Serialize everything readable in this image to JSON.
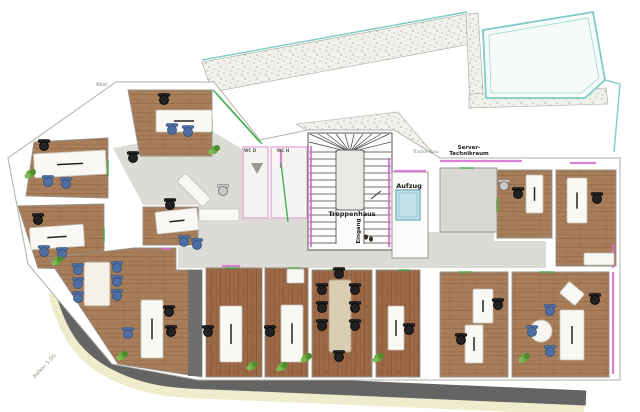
{
  "labels": {
    "treppenhaus": {
      "text": "Treppenhaus"
    },
    "eingang": {
      "text": "Eingang"
    },
    "aufzug": {
      "text": "Aufzug"
    },
    "server_line1": {
      "text": "Server-"
    },
    "server_line2": {
      "text": "Technikraum"
    },
    "trockenbau": {
      "text": "Trockenbau"
    },
    "wc_d": {
      "text": "WC D"
    },
    "wc_h": {
      "text": "WC H"
    },
    "abst": {
      "text": "Abst."
    },
    "balkon": {
      "text": "Balkon 5.OG"
    }
  },
  "colors": {
    "wood": "#a87e5a",
    "wood_red": "#9c6947",
    "corridor": "#dcdbd6",
    "road": "#646464",
    "road_edge": "#efeccd",
    "terrace_teal": "#7fccc4",
    "wall_accent": "#d66fd0",
    "glass_green": "#3fae4a",
    "elevator_blue": "#c2e2ea",
    "chair_blue": "#4e6fa4",
    "chair_black": "#222222",
    "desk_white": "#f9f8f4",
    "plant_green": "#5d9b3c",
    "wc_wall_pink": "#dfa6d6",
    "dark_strip": "#6e6e6e"
  },
  "floor_plan": {
    "base_outline": [
      [
        116,
        82
      ],
      [
        214,
        82
      ],
      [
        260,
        140
      ],
      [
        308,
        130
      ],
      [
        394,
        130
      ],
      [
        440,
        158
      ],
      [
        620,
        158
      ],
      [
        620,
        380
      ],
      [
        198,
        380
      ],
      [
        112,
        364
      ],
      [
        28,
        264
      ],
      [
        8,
        158
      ]
    ],
    "terrace": {
      "bands": [
        [
          [
            202,
            62
          ],
          [
            467,
            14
          ],
          [
            471,
            44
          ],
          [
            212,
            92
          ]
        ],
        [
          [
            466,
            14
          ],
          [
            478,
            13
          ],
          [
            484,
            106
          ],
          [
            470,
            108
          ]
        ],
        [
          [
            469,
            94
          ],
          [
            606,
            88
          ],
          [
            608,
            104
          ],
          [
            469,
            108
          ]
        ],
        [
          [
            296,
            124
          ],
          [
            398,
            112
          ],
          [
            436,
            157
          ],
          [
            392,
            131
          ],
          [
            308,
            131
          ]
        ]
      ],
      "roof_outer": [
        [
          483,
          30
        ],
        [
          593,
          12
        ],
        [
          605,
          80
        ],
        [
          585,
          98
        ],
        [
          486,
          98
        ]
      ],
      "roof_inner": [
        [
          489,
          35
        ],
        [
          588,
          18
        ],
        [
          599,
          78
        ],
        [
          581,
          93
        ],
        [
          491,
          93
        ]
      ],
      "teal_lines": [
        [
          202,
          60,
          467,
          12
        ],
        [
          605,
          80,
          620,
          84
        ],
        [
          620,
          84,
          614,
          152
        ]
      ]
    },
    "road": {
      "edge_path": "M56,292 C66,330 80,354 110,370 C140,386 168,390 212,391 L584,407",
      "main_path": "M62,288 C72,324 84,346 114,362 C142,377 168,381 212,382 L586,398"
    },
    "corridors": [
      [
        [
          113,
          148
        ],
        [
          210,
          130
        ],
        [
          244,
          150
        ],
        [
          244,
          205
        ],
        [
          143,
          205
        ]
      ],
      [
        [
          198,
          205
        ],
        [
          244,
          205
        ],
        [
          244,
          268
        ],
        [
          178,
          268
        ],
        [
          178,
          247
        ],
        [
          198,
          247
        ]
      ],
      [
        [
          244,
          218
        ],
        [
          308,
          218
        ],
        [
          308,
          268
        ],
        [
          244,
          268
        ]
      ],
      [
        [
          308,
          250
        ],
        [
          432,
          250
        ],
        [
          432,
          268
        ],
        [
          308,
          268
        ]
      ],
      [
        [
          420,
          232
        ],
        [
          494,
          232
        ],
        [
          494,
          241
        ],
        [
          546,
          241
        ],
        [
          546,
          268
        ],
        [
          420,
          268
        ]
      ]
    ],
    "rooms": [
      {
        "name": "office-a",
        "floor": "woodH",
        "points": [
          [
            34,
            142
          ],
          [
            108,
            138
          ],
          [
            108,
            198
          ],
          [
            26,
            196
          ]
        ]
      },
      {
        "name": "office-b",
        "floor": "woodH",
        "points": [
          [
            128,
            90
          ],
          [
            212,
            90
          ],
          [
            212,
            156
          ],
          [
            140,
            156
          ]
        ]
      },
      {
        "name": "office-c",
        "floor": "woodH",
        "points": [
          [
            18,
            206
          ],
          [
            104,
            204
          ],
          [
            104,
            270
          ],
          [
            38,
            268
          ]
        ]
      },
      {
        "name": "office-d",
        "floor": "woodH",
        "points": [
          [
            143,
            207
          ],
          [
            198,
            207
          ],
          [
            198,
            245
          ],
          [
            143,
            245
          ]
        ]
      },
      {
        "name": "open-office",
        "floor": "woodH",
        "points": [
          [
            48,
            258
          ],
          [
            134,
            248
          ],
          [
            176,
            248
          ],
          [
            176,
            270
          ],
          [
            202,
            270
          ],
          [
            202,
            377
          ],
          [
            118,
            364
          ]
        ]
      },
      {
        "name": "office-g",
        "floor": "woodV",
        "points": [
          [
            206,
            268
          ],
          [
            262,
            268
          ],
          [
            262,
            377
          ],
          [
            206,
            377
          ]
        ]
      },
      {
        "name": "office-h",
        "floor": "woodV",
        "points": [
          [
            265,
            268
          ],
          [
            308,
            268
          ],
          [
            308,
            377
          ],
          [
            265,
            377
          ]
        ]
      },
      {
        "name": "conference-room",
        "floor": "woodV",
        "points": [
          [
            312,
            270
          ],
          [
            372,
            270
          ],
          [
            372,
            377
          ],
          [
            312,
            377
          ]
        ]
      },
      {
        "name": "office-i",
        "floor": "woodV",
        "points": [
          [
            376,
            270
          ],
          [
            420,
            270
          ],
          [
            420,
            377
          ],
          [
            376,
            377
          ]
        ]
      },
      {
        "name": "office-j",
        "floor": "woodH",
        "points": [
          [
            440,
            272
          ],
          [
            508,
            272
          ],
          [
            508,
            377
          ],
          [
            440,
            377
          ]
        ]
      },
      {
        "name": "office-k",
        "floor": "woodH",
        "points": [
          [
            512,
            272
          ],
          [
            609,
            272
          ],
          [
            609,
            377
          ],
          [
            512,
            377
          ]
        ]
      },
      {
        "name": "office-l",
        "floor": "woodH",
        "points": [
          [
            497,
            170
          ],
          [
            552,
            170
          ],
          [
            552,
            238
          ],
          [
            497,
            238
          ]
        ]
      },
      {
        "name": "office-m",
        "floor": "woodH",
        "points": [
          [
            556,
            170
          ],
          [
            616,
            170
          ],
          [
            616,
            266
          ],
          [
            556,
            266
          ]
        ]
      },
      {
        "name": "server-room",
        "floor": "gray",
        "points": [
          [
            440,
            168
          ],
          [
            497,
            168
          ],
          [
            497,
            232
          ],
          [
            440,
            232
          ]
        ]
      },
      {
        "name": "wc-d",
        "floor": "wc",
        "points": [
          [
            243,
            147
          ],
          [
            268,
            147
          ],
          [
            268,
            218
          ],
          [
            243,
            218
          ]
        ]
      },
      {
        "name": "wc-h",
        "floor": "wc",
        "points": [
          [
            271,
            147
          ],
          [
            307,
            147
          ],
          [
            307,
            218
          ],
          [
            271,
            218
          ]
        ]
      }
    ],
    "dark_strips": [
      [
        188,
        270,
        14,
        106
      ]
    ],
    "stair": {
      "x": 308,
      "y": 133,
      "w": 84,
      "h": 117,
      "landing": [
        336,
        150,
        28,
        60
      ]
    },
    "elevator": {
      "room": [
        392,
        172,
        36,
        86
      ],
      "shaft": [
        396,
        190,
        24,
        30
      ]
    },
    "magenta_walls": [
      [
        440,
        161,
        522,
        161
      ],
      [
        570,
        163,
        596,
        163
      ],
      [
        613,
        244,
        613,
        268
      ],
      [
        613,
        272,
        613,
        374
      ],
      [
        311,
        146,
        311,
        247
      ],
      [
        389,
        158,
        389,
        247
      ],
      [
        222,
        266,
        240,
        266
      ],
      [
        162,
        249,
        170,
        249
      ],
      [
        394,
        171,
        426,
        171
      ],
      [
        281,
        150,
        281,
        168
      ]
    ],
    "green_doors": [
      [
        108,
        160,
        108,
        176
      ],
      [
        104,
        228,
        104,
        242
      ],
      [
        212,
        118,
        212,
        134
      ],
      [
        225,
        268,
        239,
        268
      ],
      [
        288,
        268,
        300,
        268
      ],
      [
        330,
        270,
        344,
        270
      ],
      [
        398,
        270,
        410,
        270
      ],
      [
        458,
        272,
        472,
        272
      ],
      [
        540,
        272,
        554,
        272
      ],
      [
        497,
        198,
        497,
        212
      ],
      [
        460,
        168,
        474,
        168
      ],
      [
        213,
        90,
        259,
        141
      ],
      [
        216,
        93,
        262,
        144
      ],
      [
        281,
        163,
        288,
        222
      ]
    ],
    "desks": [
      {
        "r": [
          34,
          152,
          72,
          24
        ],
        "rot": -3
      },
      {
        "r": [
          156,
          110,
          56,
          22
        ]
      },
      {
        "r": [
          30,
          226,
          54,
          22
        ],
        "rot": -4
      },
      {
        "r": [
          156,
          210,
          42,
          22
        ],
        "rot": -6
      },
      {
        "r": [
          141,
          300,
          22,
          58
        ]
      },
      {
        "r": [
          220,
          306,
          22,
          56
        ]
      },
      {
        "r": [
          281,
          305,
          22,
          57
        ]
      },
      {
        "r": [
          388,
          306,
          16,
          44
        ]
      },
      {
        "r": [
          473,
          289,
          20,
          34
        ]
      },
      {
        "r": [
          465,
          325,
          18,
          38
        ]
      },
      {
        "r": [
          560,
          310,
          24,
          50
        ]
      },
      {
        "r": [
          562,
          286,
          20,
          15
        ],
        "rot": 40,
        "plain": true
      },
      {
        "r": [
          526,
          175,
          17,
          38
        ]
      },
      {
        "r": [
          567,
          178,
          20,
          45
        ]
      },
      {
        "r": [
          584,
          253,
          30,
          12
        ],
        "plain": true
      },
      {
        "r": [
          287,
          269,
          17,
          14
        ],
        "plain": true
      },
      {
        "r": [
          176,
          184,
          36,
          12
        ],
        "rot": 45,
        "plain": true
      },
      {
        "r": [
          199,
          209,
          40,
          12
        ],
        "plain": true
      }
    ],
    "tables": [
      {
        "kind": "conf",
        "r": [
          329,
          280,
          22,
          72
        ]
      },
      {
        "kind": "meet",
        "r": [
          84,
          262,
          26,
          44
        ]
      },
      {
        "kind": "round",
        "c": [
          541,
          331,
          11
        ]
      }
    ],
    "chairs": [
      [
        48,
        182,
        "blue"
      ],
      [
        66,
        184,
        "blue"
      ],
      [
        44,
        146,
        "black"
      ],
      [
        172,
        130,
        "blue"
      ],
      [
        188,
        132,
        "blue"
      ],
      [
        164,
        100,
        "black"
      ],
      [
        44,
        252,
        "blue"
      ],
      [
        62,
        254,
        "blue"
      ],
      [
        38,
        220,
        "black"
      ],
      [
        184,
        242,
        "blue"
      ],
      [
        197,
        245,
        "blue"
      ],
      [
        170,
        205,
        "black"
      ],
      [
        78,
        270,
        "blue"
      ],
      [
        78,
        284,
        "blue"
      ],
      [
        78,
        298,
        "blue"
      ],
      [
        117,
        268,
        "blue"
      ],
      [
        117,
        282,
        "blue"
      ],
      [
        117,
        296,
        "blue"
      ],
      [
        169,
        312,
        "black"
      ],
      [
        171,
        332,
        "black"
      ],
      [
        128,
        334,
        "blue"
      ],
      [
        208,
        332,
        "black"
      ],
      [
        270,
        332,
        "black"
      ],
      [
        322,
        290,
        "black"
      ],
      [
        322,
        308,
        "black"
      ],
      [
        322,
        326,
        "black"
      ],
      [
        355,
        290,
        "black"
      ],
      [
        355,
        308,
        "black"
      ],
      [
        355,
        326,
        "black"
      ],
      [
        339,
        274,
        "black"
      ],
      [
        339,
        357,
        "black"
      ],
      [
        409,
        330,
        "black"
      ],
      [
        498,
        305,
        "black"
      ],
      [
        461,
        340,
        "black"
      ],
      [
        550,
        311,
        "blue"
      ],
      [
        532,
        332,
        "blue"
      ],
      [
        550,
        352,
        "blue"
      ],
      [
        595,
        300,
        "black"
      ],
      [
        518,
        194,
        "black"
      ],
      [
        504,
        186,
        "gray"
      ],
      [
        597,
        199,
        "black"
      ],
      [
        223,
        191,
        "gray"
      ],
      [
        133,
        158,
        "black"
      ]
    ],
    "plants": [
      [
        30,
        174
      ],
      [
        214,
        150
      ],
      [
        57,
        261
      ],
      [
        122,
        356
      ],
      [
        252,
        366
      ],
      [
        282,
        367
      ],
      [
        306,
        358
      ],
      [
        378,
        358
      ],
      [
        524,
        358
      ]
    ],
    "misc": {
      "triangle": [
        [
          251,
          163
        ],
        [
          263,
          163
        ],
        [
          257,
          174
        ]
      ],
      "footprints": [
        [
          366,
          237
        ],
        [
          371,
          239
        ]
      ],
      "arrow": [
        371,
        199,
        381,
        191
      ]
    }
  }
}
